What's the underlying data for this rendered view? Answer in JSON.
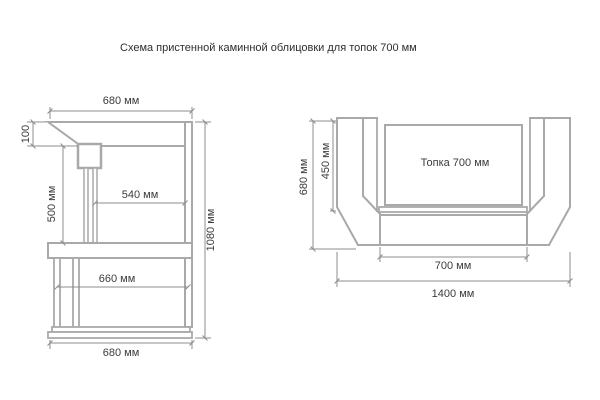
{
  "page": {
    "title": "Схема пристенной каминной облицовки для топок 700 мм"
  },
  "colors": {
    "outline_line": "#a9a9a9",
    "dimension_line": "#8c8c8c",
    "text": "#3c3c3c",
    "background": "#ffffff"
  },
  "side_view": {
    "label_top_width": "680 мм",
    "label_hood_height": "100",
    "label_opening_height": "500 мм",
    "label_opening_width": "540 мм",
    "label_total_height": "1080 мм",
    "label_shelf_width": "660 мм",
    "label_base_width": "680 мм"
  },
  "plan_view": {
    "label_depth": "680 мм",
    "label_portal_depth": "450 мм",
    "label_firebox": "Топка 700 мм",
    "label_front_width": "700 мм",
    "label_total_width": "1400 мм"
  }
}
